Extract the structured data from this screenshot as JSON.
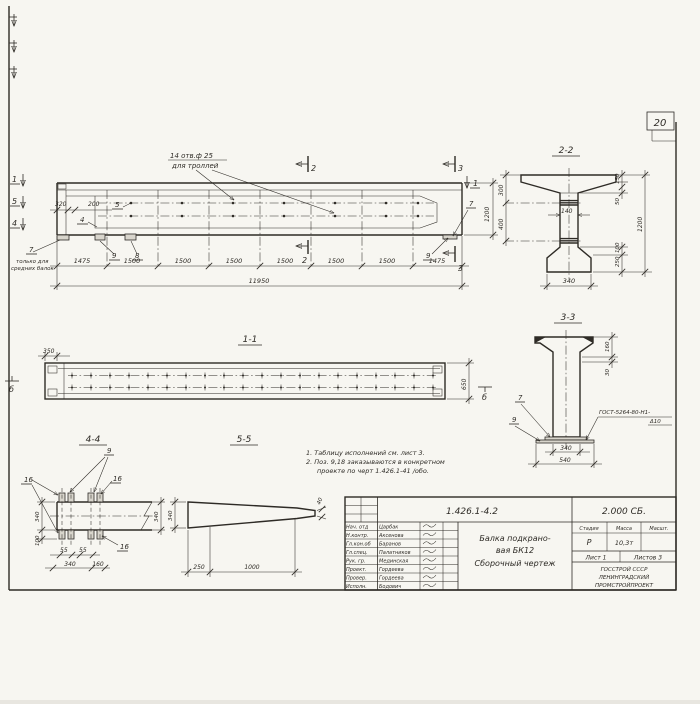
{
  "sheet": {
    "page_number": "20"
  },
  "main_view": {
    "holes_callout": {
      "line1": "14 отв.ф 25",
      "line2": "для троллей"
    },
    "left_callout": {
      "pos": "7",
      "line1": "только для",
      "line2": "средних балок"
    },
    "cut_marks": {
      "m1": "1",
      "m2": "2",
      "m3": "3",
      "m4": "4",
      "m5": "5"
    },
    "pos": {
      "p4": "4",
      "p5": "5",
      "p7": "7",
      "p8": "8",
      "p9": "9"
    },
    "dims": {
      "d320": "320",
      "d200": "200",
      "height": "1200",
      "chain": [
        "1475",
        "1500",
        "1500",
        "1500",
        "1500",
        "1500",
        "1500",
        "1475"
      ],
      "total": "11950"
    }
  },
  "view_1_1": {
    "title": "1-1",
    "marker": "б",
    "dims": {
      "d350": "350",
      "d650": "650"
    }
  },
  "section_2_2": {
    "title": "2-2",
    "dims": {
      "d300": "300",
      "d400": "400",
      "d140": "140",
      "d150": "150",
      "d50": "50",
      "d1200": "1200",
      "d100": "100",
      "d250": "250",
      "d340": "340"
    }
  },
  "section_3_3": {
    "title": "3-3",
    "pos": {
      "p7": "7",
      "p9": "9"
    },
    "weld": {
      "line1": "ГОСТ-5264-80-Н1-",
      "line2": "Δ10"
    },
    "dims": {
      "d160": "160",
      "d30": "30",
      "d340": "340",
      "d540": "540"
    }
  },
  "section_4_4": {
    "title": "4-4",
    "pos": {
      "p9": "9",
      "p16a": "16",
      "p16b": "16",
      "p16c": "16"
    },
    "dims": {
      "d340l": "340",
      "d100": "100",
      "d55a": "55",
      "d55b": "55",
      "d340b": "340",
      "d160": "160",
      "d340r": "340"
    }
  },
  "section_5_5": {
    "title": "5-5",
    "dims": {
      "d340": "340",
      "d250": "250",
      "d1000": "1000",
      "d40": "40"
    }
  },
  "notes": {
    "line1": "1. Таблицу исполнений см. лист 3.",
    "line2": "2. Поз. 9,18 заказываются в конкретном",
    "line3": "проекте по черт 1.426.1-41 /обо."
  },
  "title_block": {
    "doc_number": "1.426.1-4.2",
    "doc_code": "2.000 СБ.",
    "title_line1": "Балка подкрано-",
    "title_line2": "вая БК12",
    "title_line3": "Сборочный чертеж",
    "col_stage": "Стадия",
    "col_mass": "Масса",
    "col_scale": "Масшт.",
    "stage": "Р",
    "mass": "10,3т",
    "sheet_label": "Лист 1",
    "sheets_label": "Листов 3",
    "org_line1": "ГОССТРОЙ СССР",
    "org_line2": "ЛЕНИНГРАДСКИЙ",
    "org_line3": "ПРОМСТРОЙПРОЕКТ",
    "rows": [
      {
        "role": "Нач. отд",
        "name": "Царбак"
      },
      {
        "role": "Н.контр.",
        "name": "Аксенова"
      },
      {
        "role": "Гл.кон.об",
        "name": "Баранов"
      },
      {
        "role": "Гл.спец.",
        "name": "Палатников"
      },
      {
        "role": "Рук. гр.",
        "name": "Мединская"
      },
      {
        "role": "Проект.",
        "name": "Гордеева"
      },
      {
        "role": "Провер.",
        "name": "Гордеева"
      },
      {
        "role": "Исполн.",
        "name": "Бодович"
      }
    ]
  }
}
